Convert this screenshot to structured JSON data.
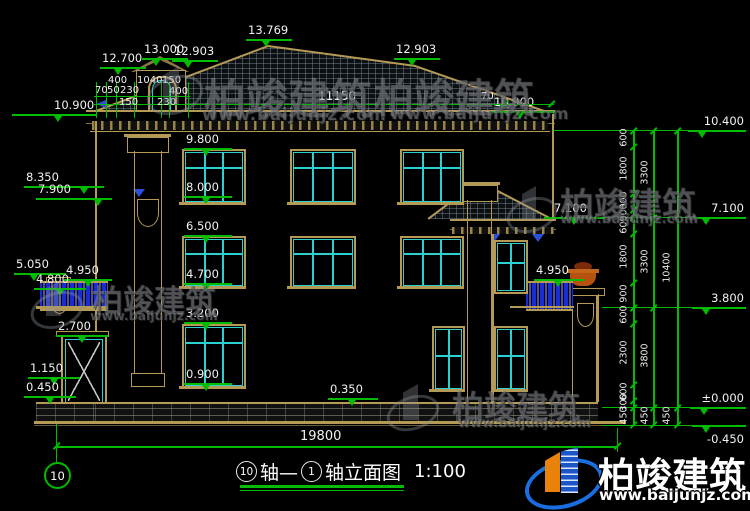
{
  "brand": {
    "name": "柏竣建筑",
    "url": "www.baijunjz.com"
  },
  "title": {
    "a": "10",
    "mid": "轴—",
    "b": "1",
    "name": "轴立面图",
    "scale": "1:100"
  },
  "axis": {
    "bubble": "10"
  },
  "lv": {
    "p13769": "13.769",
    "p13000": "13.000",
    "p12700": "12.700",
    "p12903": "12.903",
    "p10900": "10.900",
    "p10400": "10.400",
    "p9800": "9.800",
    "p8350": "8.350",
    "p8000": "8.000",
    "p7900": "7.900",
    "p7100": "7.100",
    "p6500": "6.500",
    "p5050": "5.050",
    "p4950": "4.950",
    "p4800": "4.800",
    "p4700": "4.700",
    "p3800": "3.800",
    "p3200": "3.200",
    "p2700": "2.700",
    "p1150": "1.150",
    "p0900": "0.900",
    "p0450": "0.450",
    "p0350": "0.350",
    "zero": "±0.000",
    "neg": "-0.450"
  },
  "dims": {
    "top": {
      "total": "11150",
      "edge": "70",
      "a400": "400",
      "a1040": "1040",
      "a150": "150",
      "b70": "70",
      "b50": "50",
      "b230": "230",
      "b400": "400",
      "c150": "150",
      "c230": "230"
    },
    "right": {
      "c1": [
        "600",
        "1800",
        "600",
        "300",
        "600",
        "1800",
        "900",
        "600",
        "2300",
        "600",
        "300",
        "450"
      ],
      "c2": [
        "3300",
        "3300",
        "3800",
        "450"
      ],
      "c3": [
        "10400",
        "450"
      ]
    },
    "bottom": {
      "total": "19800"
    }
  },
  "colors": {
    "annotation": "#00bb00",
    "outline": "#b49a55",
    "window": "#2bd0d0",
    "baluster": "#1c2bd8",
    "background": "#000000"
  }
}
